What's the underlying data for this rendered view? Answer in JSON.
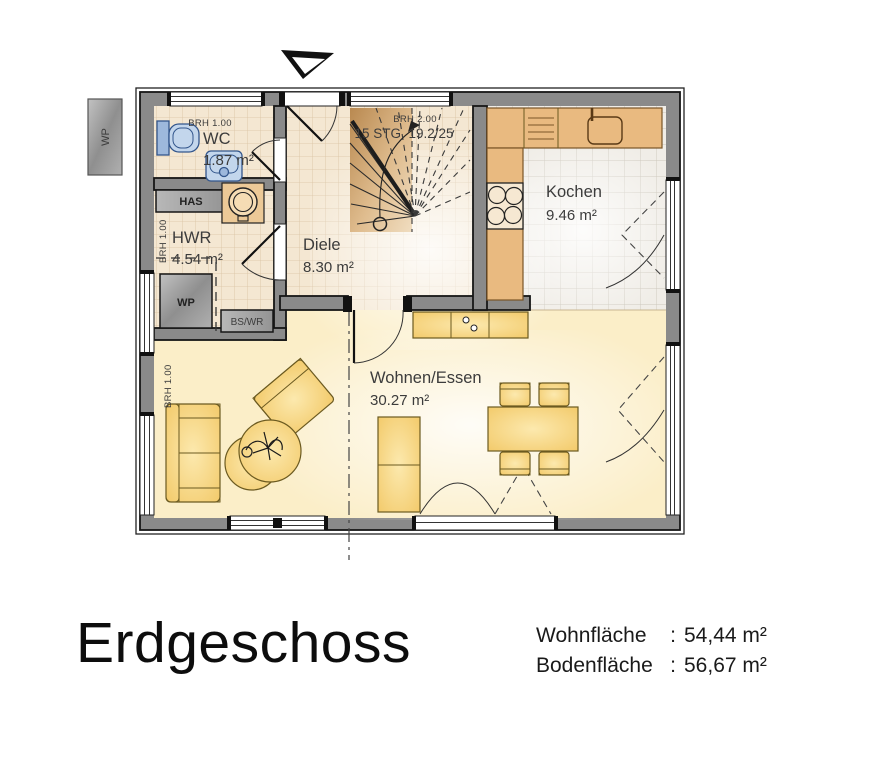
{
  "plan": {
    "exterior": {
      "wp_unit": "WP"
    },
    "rooms": {
      "wc": {
        "name": "WC",
        "area": "1.87 m²",
        "window_note": "BRH 1.00"
      },
      "hwr": {
        "name": "HWR",
        "area": "4.54 m²",
        "window_note": "BRH 1.00",
        "has_label": "HAS",
        "wp_label": "WP",
        "bswr_label": "BS/WR"
      },
      "diele": {
        "name": "Diele",
        "area": "8.30 m²"
      },
      "stairs": {
        "label": "15 STG. 19.2/25",
        "window_note": "BRH 2.00"
      },
      "kochen": {
        "name": "Kochen",
        "area": "9.46 m²"
      },
      "wohnen": {
        "name": "Wohnen/Essen",
        "area": "30.27 m²",
        "window_note": "BRH 1.00"
      }
    }
  },
  "caption": {
    "title": "Erdgeschoss",
    "stats": [
      {
        "label": "Wohnfläche",
        "sep": ":",
        "value": "54,44 m²"
      },
      {
        "label": "Bodenfläche",
        "sep": ":",
        "value": "56,67 m²"
      }
    ]
  },
  "colors": {
    "wall": "#8a8a8a",
    "tile_beige": "#f4e7d2",
    "tile_kitchen": "#f0ede7",
    "floor_living": "#fbeec8",
    "furniture": "#f5cd74",
    "counter": "#e9ba80",
    "fixture_blue": "#b9cfe7",
    "stair_wood": "#d8ab74",
    "label_text": "#3c3c3c"
  }
}
